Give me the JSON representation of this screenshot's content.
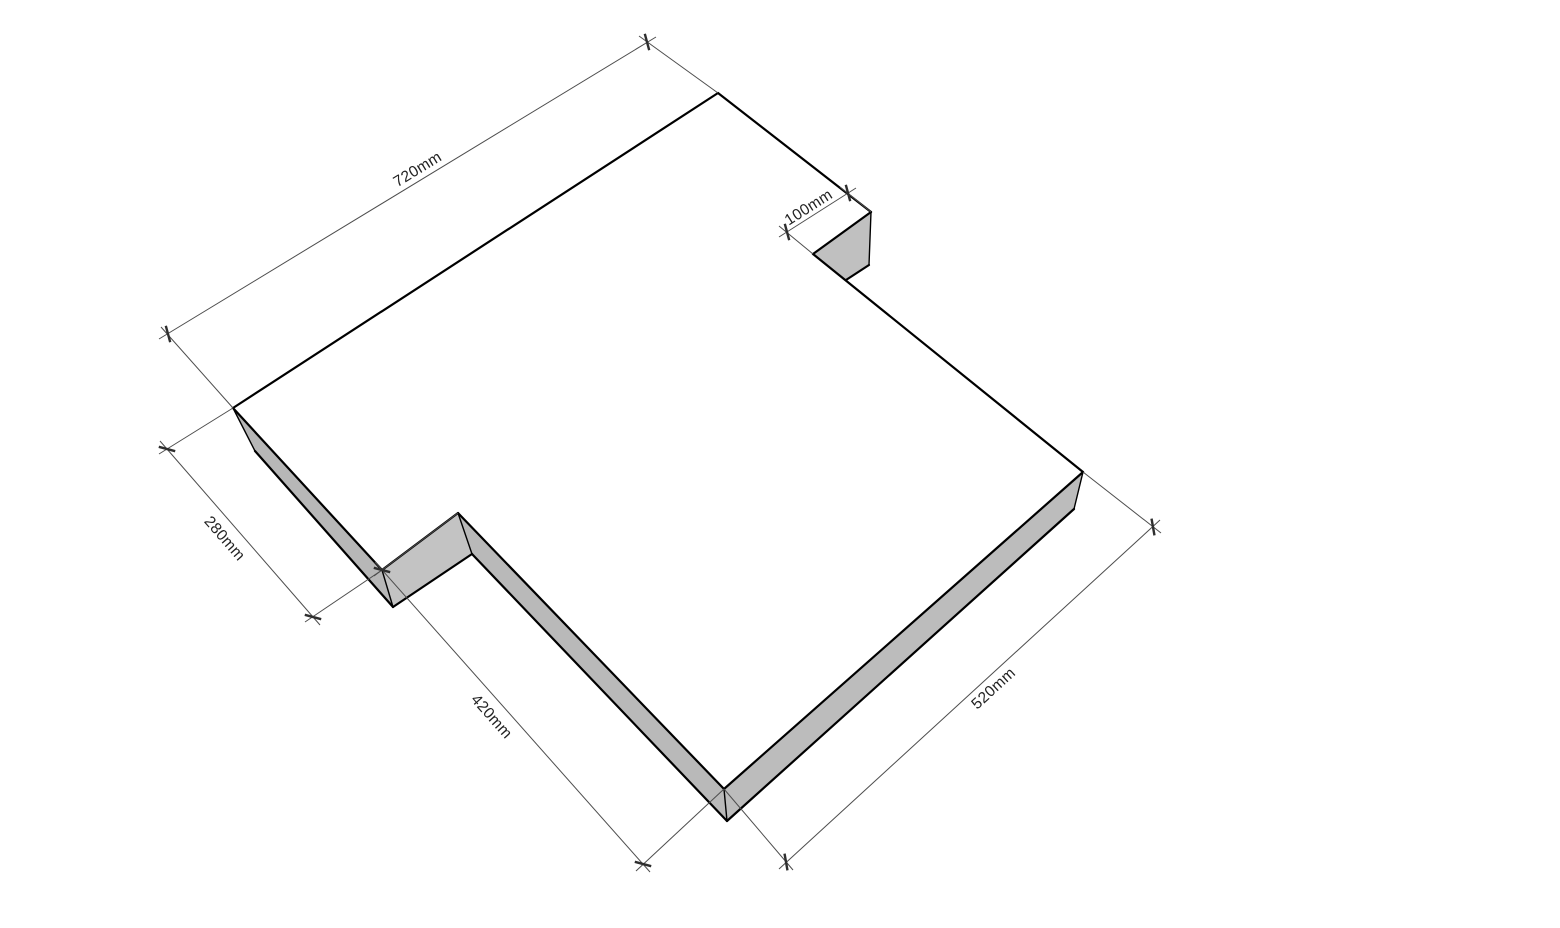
{
  "app": {
    "name": "3d-cad-viewport",
    "background": "#ffffff"
  },
  "canvas": {
    "width": 1560,
    "height": 928
  },
  "palette": {
    "top_face": "#ffffff",
    "edge": "#000000",
    "dim_line": "#4d4d4d",
    "tick": "#2e2e2e",
    "text": "#222222"
  },
  "model": {
    "description": "flat slab with two step notches, isometric-perspective view",
    "faces": [
      {
        "name": "top-face",
        "fill": "#ffffff",
        "points": [
          [
            718,
            93
          ],
          [
            871,
            212
          ],
          [
            813,
            254
          ],
          [
            1083,
            472
          ],
          [
            724,
            789
          ],
          [
            458,
            513
          ],
          [
            382,
            570
          ],
          [
            233,
            408
          ]
        ]
      },
      {
        "name": "side-face-280-edge",
        "fill": "#b7b7b7",
        "points": [
          [
            233,
            408
          ],
          [
            382,
            570
          ],
          [
            393,
            607
          ],
          [
            255,
            451
          ]
        ]
      },
      {
        "name": "side-face-step",
        "fill": "#c3c3c3",
        "points": [
          [
            382,
            570
          ],
          [
            458,
            513
          ],
          [
            472,
            554
          ],
          [
            393,
            607
          ]
        ]
      },
      {
        "name": "side-face-420-edge",
        "fill": "#b9b9b9",
        "points": [
          [
            458,
            513
          ],
          [
            724,
            789
          ],
          [
            727,
            821
          ],
          [
            472,
            554
          ]
        ]
      },
      {
        "name": "side-face-520-edge",
        "fill": "#bcbcbc",
        "points": [
          [
            724,
            789
          ],
          [
            1083,
            472
          ],
          [
            1074,
            509
          ],
          [
            727,
            821
          ]
        ]
      },
      {
        "name": "side-face-notch-100",
        "fill": "#c0c0c0",
        "points": [
          [
            871,
            212
          ],
          [
            813,
            254
          ],
          [
            846,
            280
          ],
          [
            869,
            265
          ]
        ]
      }
    ],
    "edges": {
      "thick": [
        [
          [
            718,
            93
          ],
          [
            871,
            212
          ]
        ],
        [
          [
            871,
            212
          ],
          [
            813,
            254
          ]
        ],
        [
          [
            813,
            254
          ],
          [
            1083,
            472
          ]
        ],
        [
          [
            1083,
            472
          ],
          [
            724,
            789
          ]
        ],
        [
          [
            724,
            789
          ],
          [
            458,
            513
          ]
        ],
        [
          [
            458,
            513
          ],
          [
            382,
            570
          ]
        ],
        [
          [
            382,
            570
          ],
          [
            233,
            408
          ]
        ],
        [
          [
            233,
            408
          ],
          [
            718,
            93
          ]
        ],
        [
          [
            255,
            451
          ],
          [
            393,
            607
          ]
        ],
        [
          [
            393,
            607
          ],
          [
            472,
            554
          ]
        ],
        [
          [
            472,
            554
          ],
          [
            727,
            821
          ]
        ],
        [
          [
            727,
            821
          ],
          [
            1074,
            509
          ]
        ],
        [
          [
            846,
            280
          ],
          [
            869,
            265
          ]
        ]
      ],
      "thin": [
        [
          [
            233,
            408
          ],
          [
            255,
            451
          ]
        ],
        [
          [
            382,
            570
          ],
          [
            393,
            607
          ]
        ],
        [
          [
            458,
            513
          ],
          [
            472,
            554
          ]
        ],
        [
          [
            724,
            789
          ],
          [
            727,
            821
          ]
        ],
        [
          [
            1083,
            472
          ],
          [
            1074,
            509
          ]
        ],
        [
          [
            871,
            212
          ],
          [
            869,
            265
          ]
        ]
      ]
    }
  },
  "dimensions": [
    {
      "label": "720mm",
      "line": [
        [
          656,
          37
        ],
        [
          159,
          339
        ]
      ],
      "ticks": [
        [
          647,
          42
        ],
        [
          168,
          334
        ]
      ],
      "tick_angle_deg": 75,
      "extensions": [
        [
          [
            718,
            93
          ],
          [
            639,
            36
          ]
        ],
        [
          [
            233,
            408
          ],
          [
            161,
            327
          ]
        ]
      ],
      "label_pos": [
        418,
        170
      ],
      "label_angle_deg": -31.4
    },
    {
      "label": "100mm",
      "line": [
        [
          856,
          188
        ],
        [
          779,
          237
        ]
      ],
      "ticks": [
        [
          848,
          193
        ],
        [
          787,
          232
        ]
      ],
      "tick_angle_deg": 75,
      "extensions": [
        [
          [
            871,
            212
          ],
          [
            840,
            187
          ]
        ],
        [
          [
            813,
            254
          ],
          [
            779,
            226
          ]
        ]
      ],
      "label_pos": [
        809,
        208
      ],
      "label_angle_deg": -32.6
    },
    {
      "label": "280mm",
      "line": [
        [
          160,
          441
        ],
        [
          320,
          625
        ]
      ],
      "ticks": [
        [
          167,
          449
        ],
        [
          313,
          617
        ]
      ],
      "tick_angle_deg": 15,
      "extensions": [
        [
          [
            233,
            408
          ],
          [
            159,
            454
          ]
        ],
        [
          [
            382,
            570
          ],
          [
            305,
            622
          ]
        ]
      ],
      "label_pos": [
        224,
        539
      ],
      "label_angle_deg": 49.0
    },
    {
      "label": "420mm",
      "line": [
        [
          375,
          562
        ],
        [
          650,
          872
        ]
      ],
      "ticks": [
        [
          382,
          570
        ],
        [
          643,
          864
        ]
      ],
      "tick_angle_deg": 15,
      "extensions": [
        [
          [
            458,
            513
          ],
          [
            374,
            576
          ]
        ],
        [
          [
            724,
            789
          ],
          [
            636,
            871
          ]
        ]
      ],
      "label_pos": [
        491,
        717
      ],
      "label_angle_deg": 48.4
    },
    {
      "label": "520mm",
      "line": [
        [
          779,
          869
        ],
        [
          1160,
          520
        ]
      ],
      "ticks": [
        [
          786,
          862
        ],
        [
          1153,
          527
        ]
      ],
      "tick_angle_deg": 80,
      "extensions": [
        [
          [
            724,
            789
          ],
          [
            793,
            870
          ]
        ],
        [
          [
            1083,
            472
          ],
          [
            1161,
            533
          ]
        ]
      ],
      "label_pos": [
        994,
        689
      ],
      "label_angle_deg": -42.4
    }
  ]
}
